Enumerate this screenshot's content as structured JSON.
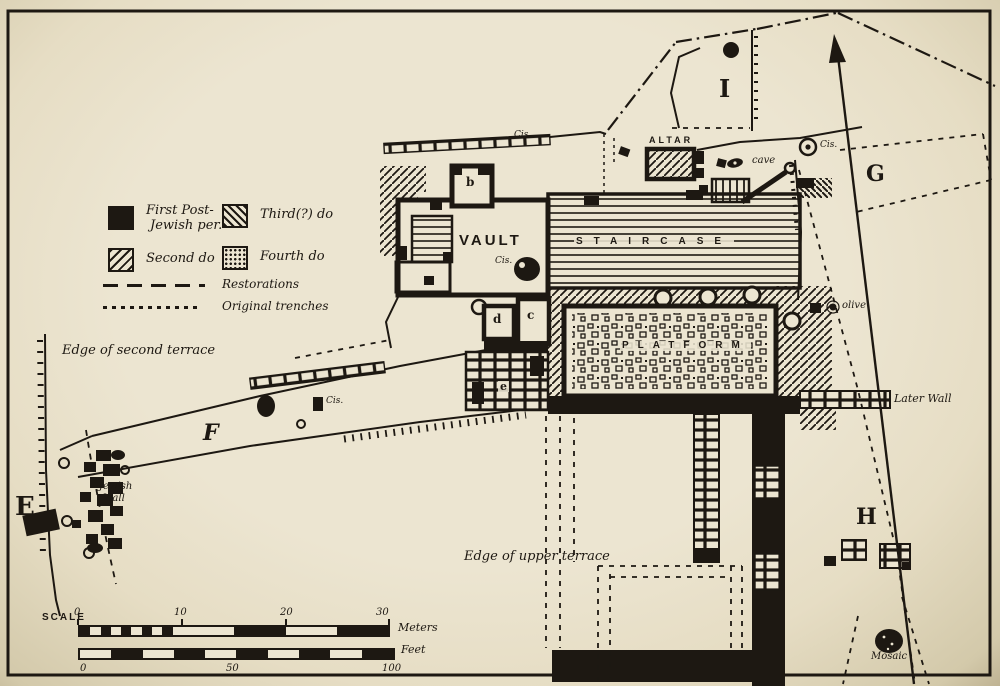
{
  "colors": {
    "paper": "#ece5d1",
    "ink": "#1d1812"
  },
  "legend": {
    "first_line1": "First Post-",
    "first_line2": "Jewish per.",
    "second": "Second do",
    "third": "Third(?) do",
    "fourth": "Fourth do",
    "restorations": "Restorations",
    "trenches": "Original trenches"
  },
  "features": {
    "vault": "VAULT",
    "staircase": "STAIRCASE",
    "platform": "PLATFORM",
    "altar": "ALTAR",
    "later_wall": "Later Wall",
    "jewish_wall_line1": "Jewish",
    "jewish_wall_line2": "Wall",
    "edge_second_terrace": "Edge of second terrace",
    "edge_upper_terrace": "Edge of upper terrace",
    "olive": "olive",
    "mosaic": "Mosaic",
    "cave": "cave",
    "cistern_abbr": "Cis."
  },
  "trench_letters": {
    "e": "E",
    "f": "F",
    "g": "G",
    "h": "H",
    "i": "I"
  },
  "room_letters": {
    "b": "b",
    "c": "c",
    "d": "d",
    "e": "e"
  },
  "scale": {
    "title": "SCALE",
    "meters_label": "Meters",
    "feet_label": "Feet",
    "meters_ticks": [
      "0",
      "10",
      "20",
      "30"
    ],
    "feet_ticks": [
      "0",
      "50",
      "100"
    ]
  }
}
